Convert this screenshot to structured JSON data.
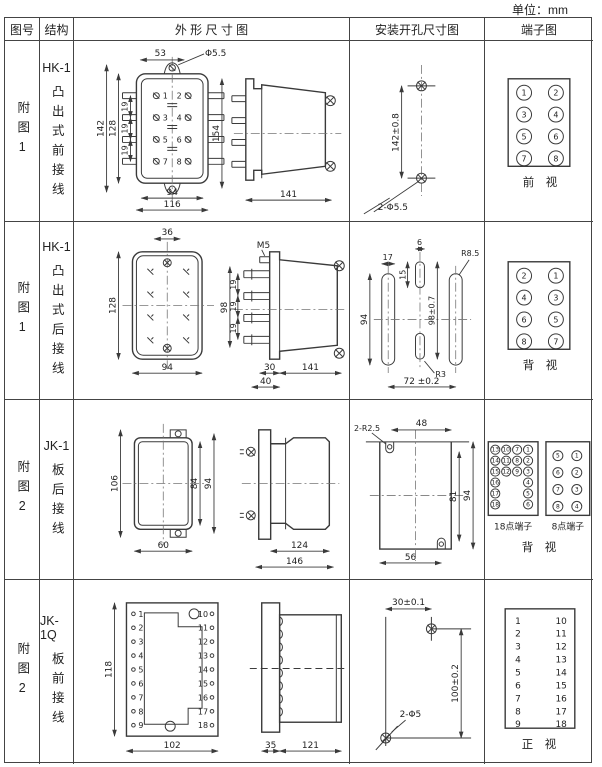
{
  "unit": "单位：mm",
  "header": {
    "figure": "图号",
    "structure": "结构",
    "outline": "外 形 尺 寸 图",
    "mounting": "安装开孔尺寸图",
    "terminal": "端子图"
  },
  "rows": [
    {
      "figure": "附图1",
      "model": "HK-1",
      "wiring": "凸出式前接线",
      "outline": {
        "d53": "53",
        "hole": "Φ5.5",
        "d142": "142",
        "d128": "128",
        "p1": "19",
        "p2": "19",
        "p3": "19",
        "d94": "94",
        "d116": "116",
        "pins": [
          "1",
          "2",
          "3",
          "4",
          "5",
          "6",
          "7",
          "8"
        ],
        "d154": "154",
        "d141": "141"
      },
      "mounting": {
        "v": "142±0.8",
        "holes": "2-Φ5.5"
      },
      "terminal": {
        "pins": [
          [
            "1",
            "2"
          ],
          [
            "3",
            "4"
          ],
          [
            "5",
            "6"
          ],
          [
            "7",
            "8"
          ]
        ],
        "caption": "前 视"
      }
    },
    {
      "figure": "附图1",
      "model": "HK-1",
      "wiring": "凸出式后接线",
      "outline": {
        "d36": "36",
        "d128": "128",
        "d94": "94",
        "m5": "M5",
        "d98": "98",
        "p1": "19",
        "p2": "19",
        "p3": "19",
        "d30": "30",
        "d40": "40",
        "d141": "141"
      },
      "mounting": {
        "d17": "17",
        "d6": "6",
        "d15": "15",
        "r85": "R8.5",
        "d94": "94",
        "d98": "98±0.7",
        "r3": "R3",
        "d72": "72 ±0.2"
      },
      "terminal": {
        "pins": [
          [
            "2",
            "1"
          ],
          [
            "4",
            "3"
          ],
          [
            "6",
            "5"
          ],
          [
            "8",
            "7"
          ]
        ],
        "caption": "背 视"
      }
    },
    {
      "figure": "附图2",
      "model": "JK-1",
      "wiring": "板后接线",
      "outline": {
        "d106": "106",
        "d84": "84",
        "d94": "94",
        "d60": "60",
        "d124": "124",
        "d146": "146"
      },
      "mounting": {
        "r25": "2-R2.5",
        "d48": "48",
        "d81": "81",
        "d94": "94",
        "d56": "56"
      },
      "terminal": {
        "t18_c1": [
          "13",
          "14",
          "15",
          "16",
          "17",
          "18"
        ],
        "t18_c2": [
          "10",
          "11",
          "12"
        ],
        "t18_c3": [
          "7",
          "8",
          "9"
        ],
        "t18_c4": [
          "1",
          "2",
          "3",
          "4",
          "5",
          "6"
        ],
        "t18_label": "18点端子",
        "t8_left": [
          "5",
          "6",
          "7",
          "8"
        ],
        "t8_right": [
          "1",
          "2",
          "3",
          "4"
        ],
        "t8_label": "8点端子",
        "caption": "背 视"
      }
    },
    {
      "figure": "附图2",
      "model": "JK-1Q",
      "wiring": "板前接线",
      "outline": {
        "d118": "118",
        "left_pins": [
          "1",
          "2",
          "3",
          "4",
          "5",
          "6",
          "7",
          "8",
          "9"
        ],
        "right_pins": [
          "10",
          "11",
          "12",
          "13",
          "14",
          "15",
          "16",
          "17",
          "18"
        ],
        "d102": "102",
        "d35": "35",
        "d121": "121"
      },
      "mounting": {
        "h": "30±0.1",
        "v": "100±0.2",
        "holes": "2-Φ5"
      },
      "terminal": {
        "left": [
          "1",
          "2",
          "3",
          "4",
          "5",
          "6",
          "7",
          "8",
          "9"
        ],
        "right": [
          "10",
          "11",
          "12",
          "13",
          "14",
          "15",
          "16",
          "17",
          "18"
        ],
        "caption": "正 视"
      }
    }
  ]
}
